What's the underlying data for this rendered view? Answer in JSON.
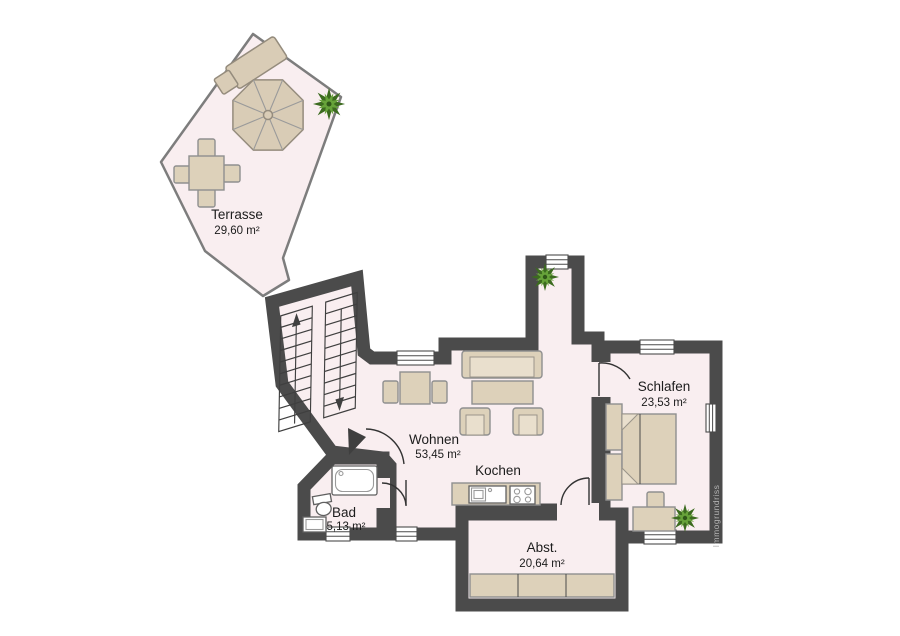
{
  "branding": {
    "watermark": "Immogrundriss"
  },
  "rooms": {
    "terrasse": {
      "name": "Terrasse",
      "area": "29,60 m²"
    },
    "wohnen": {
      "name": "Wohnen",
      "area": "53,45 m²"
    },
    "kochen": {
      "name": "Kochen"
    },
    "schlafen": {
      "name": "Schlafen",
      "area": "23,53 m²"
    },
    "bad": {
      "name": "Bad",
      "area": "5,13 m²"
    },
    "abstellraum": {
      "name": "Abst.",
      "area": "20,64 m²"
    }
  },
  "colors": {
    "wall": "#4b4b4b",
    "floor": "#f9eef0",
    "terrace_outline": "#7d7d7d",
    "furniture": "#ddd1ba",
    "furniture_outline": "#8f8f8f",
    "fixture_white": "#ffffff",
    "plant_green": "#67a33a",
    "plant_dark": "#3c6b1f",
    "label_text": "#1c1c1c",
    "watermark_text": "#b5b5b5",
    "background": "#ffffff"
  },
  "icons": {
    "stairs": "stairs-up-down-arrows",
    "plant": "potted-plant-icon",
    "parasol": "patio-umbrella-icon"
  }
}
